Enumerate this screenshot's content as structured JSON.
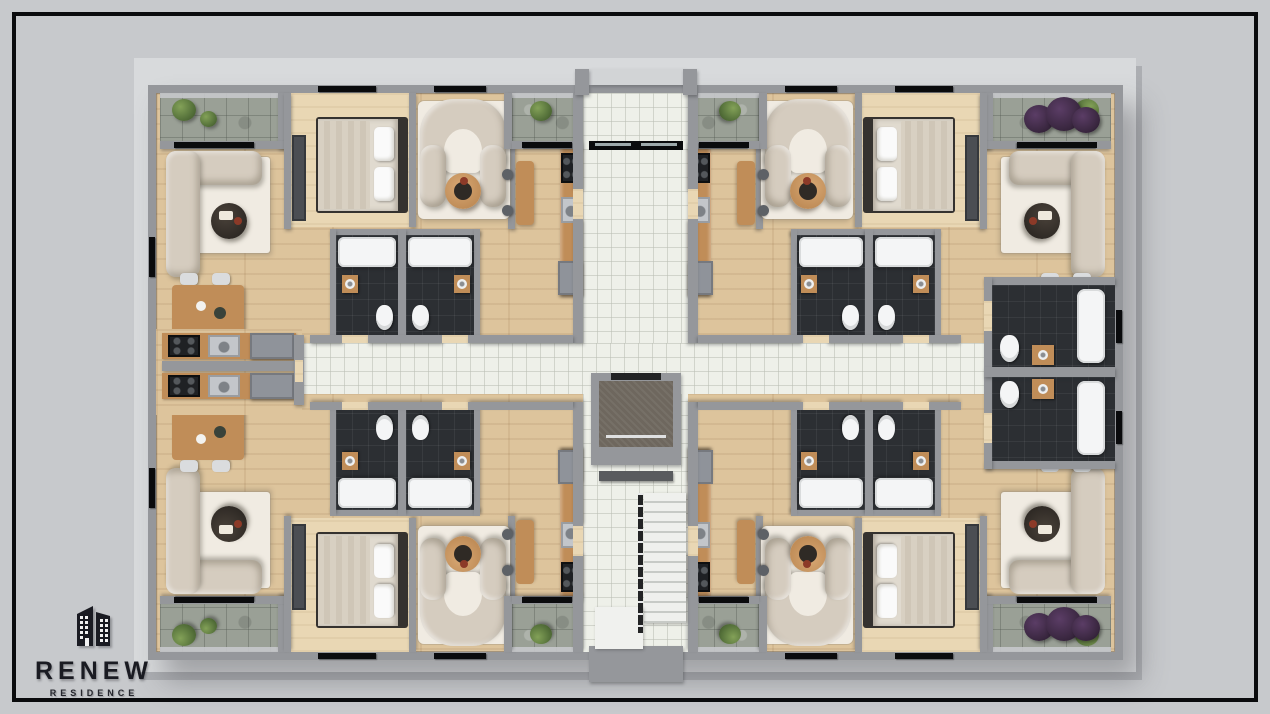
{
  "logo": {
    "title": "RENEW",
    "subtitle": "RESIDENCE",
    "icon": "twin-buildings-icon"
  },
  "palette": {
    "bg": "#c7c9cc",
    "frame": "#0a0b0d",
    "backdrop": "#d8dadc",
    "wall": "#95979b",
    "wood": "#ddc49c",
    "woodlight": "#e9d7b4",
    "tile": "#eef0e9",
    "stone": "#9aa096",
    "bath": "#2c2f33",
    "tub": "#f4f5f6",
    "sofa": "#d5ccbf",
    "rug": "#f0ebe2",
    "tabledark": "#2f2a25",
    "tablewood": "#c08d58",
    "bedm": "#e0dacf",
    "bedd": "#35322f",
    "pillowc": "#fafafa",
    "green": "#55713a",
    "purple": "#3a2740",
    "steel": "#c3c6ca",
    "steel2": "#8f939a",
    "stovec": "#1f2124",
    "logoc": "#1a1b22"
  }
}
